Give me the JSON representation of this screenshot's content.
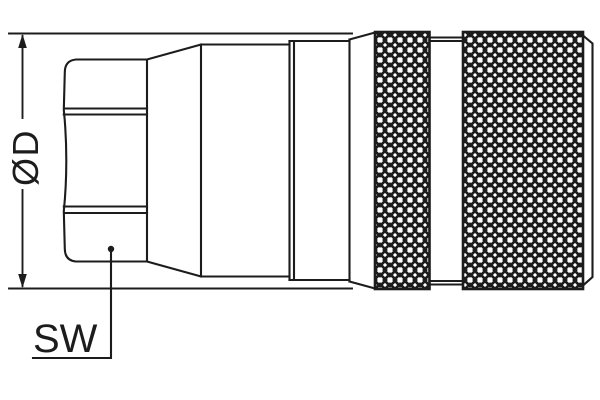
{
  "diagram": {
    "background_color": "#ffffff",
    "line_color": "#1c1c1c",
    "labels": {
      "diameter": "ØD",
      "wrench_size": "SW"
    }
  }
}
